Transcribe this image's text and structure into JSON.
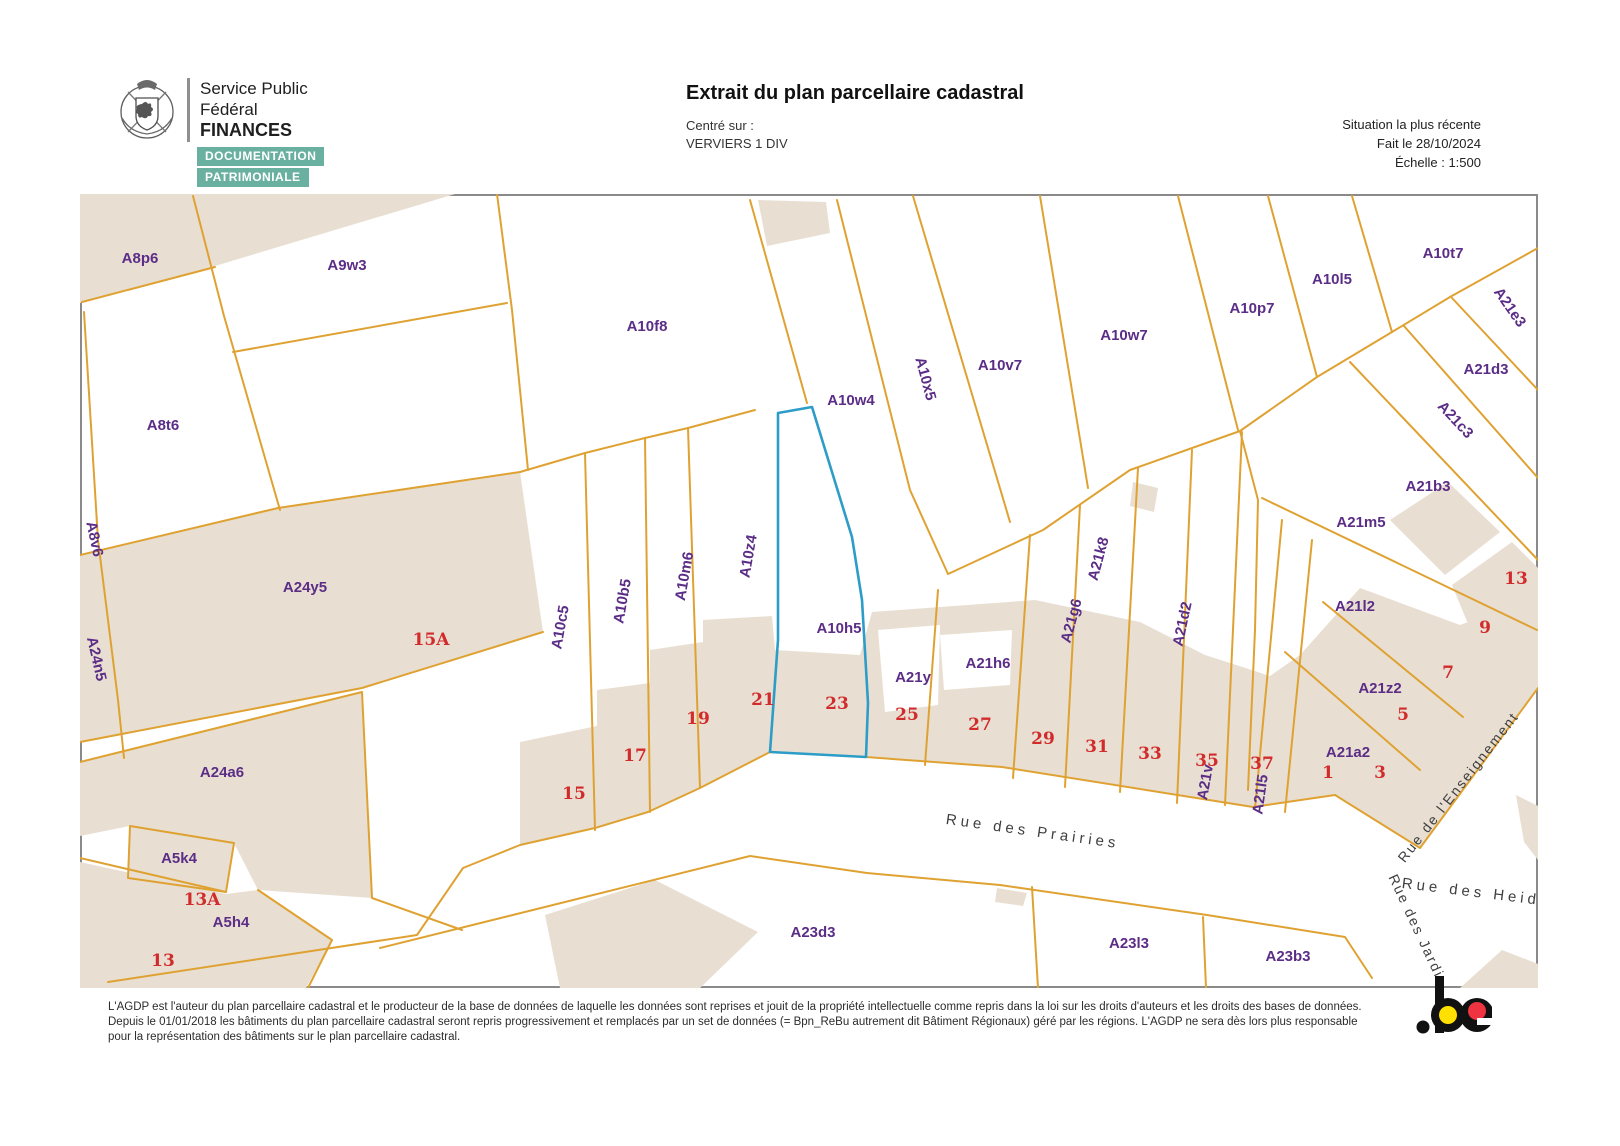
{
  "header": {
    "org_line1": "Service Public",
    "org_line2": "Fédéral",
    "org_line3": "FINANCES",
    "badge1": "DOCUMENTATION",
    "badge2": "PATRIMONIALE",
    "title": "Extrait du plan parcellaire cadastral",
    "centered_on_label": "Centré sur :",
    "centered_on_value": "VERVIERS 1 DIV",
    "situation": "Situation la plus récente",
    "date": "Fait le 28/10/2024",
    "scale": "Échelle : 1:500"
  },
  "colors": {
    "building_fill": "#e8dfd2",
    "parcel_line": "#dfa232",
    "highlight_line": "#2d9dc8",
    "parcel_label": "#5b2d86",
    "house_number": "#d22b2b",
    "street_label": "#3f3f3f",
    "badge_bg": "#6ab0a0",
    "logo_yellow": "#ffe000",
    "logo_red": "#ef3340"
  },
  "map": {
    "parcel_labels": [
      {
        "t": "A8p6",
        "x": 140,
        "y": 263,
        "r": 0
      },
      {
        "t": "A9w3",
        "x": 347,
        "y": 270,
        "r": 0
      },
      {
        "t": "A8t6",
        "x": 163,
        "y": 430,
        "r": 0
      },
      {
        "t": "A8v6",
        "x": 90,
        "y": 540,
        "r": 78
      },
      {
        "t": "A24n5",
        "x": 92,
        "y": 660,
        "r": 77
      },
      {
        "t": "A24y5",
        "x": 305,
        "y": 592,
        "r": 0
      },
      {
        "t": "A24a6",
        "x": 222,
        "y": 777,
        "r": 0
      },
      {
        "t": "A5k4",
        "x": 179,
        "y": 863,
        "r": 0
      },
      {
        "t": "A5h4",
        "x": 231,
        "y": 927,
        "r": 0
      },
      {
        "t": "A10f8",
        "x": 647,
        "y": 331,
        "r": 0
      },
      {
        "t": "A10w4",
        "x": 851,
        "y": 405,
        "r": 0
      },
      {
        "t": "A10x5",
        "x": 921,
        "y": 380,
        "r": 75
      },
      {
        "t": "A10v7",
        "x": 1000,
        "y": 370,
        "r": 0
      },
      {
        "t": "A10w7",
        "x": 1124,
        "y": 340,
        "r": 0
      },
      {
        "t": "A10p7",
        "x": 1252,
        "y": 313,
        "r": 0
      },
      {
        "t": "A10l5",
        "x": 1332,
        "y": 284,
        "r": 0
      },
      {
        "t": "A10t7",
        "x": 1443,
        "y": 258,
        "r": 0
      },
      {
        "t": "A21e3",
        "x": 1506,
        "y": 310,
        "r": 55
      },
      {
        "t": "A21d3",
        "x": 1486,
        "y": 374,
        "r": 0
      },
      {
        "t": "A21c3",
        "x": 1452,
        "y": 423,
        "r": 47
      },
      {
        "t": "A21b3",
        "x": 1428,
        "y": 491,
        "r": 0
      },
      {
        "t": "A21m5",
        "x": 1361,
        "y": 527,
        "r": 0
      },
      {
        "t": "A10c5",
        "x": 565,
        "y": 628,
        "r": -80
      },
      {
        "t": "A10b5",
        "x": 627,
        "y": 602,
        "r": -80
      },
      {
        "t": "A10m6",
        "x": 689,
        "y": 577,
        "r": -80
      },
      {
        "t": "A10z4",
        "x": 753,
        "y": 557,
        "r": -80
      },
      {
        "t": "A10h5",
        "x": 839,
        "y": 633,
        "r": 0
      },
      {
        "t": "A21y",
        "x": 913,
        "y": 682,
        "r": 0
      },
      {
        "t": "A21h6",
        "x": 988,
        "y": 668,
        "r": 0
      },
      {
        "t": "A21g6",
        "x": 1076,
        "y": 622,
        "r": -75
      },
      {
        "t": "A21k8",
        "x": 1103,
        "y": 560,
        "r": -75
      },
      {
        "t": "A21d2",
        "x": 1187,
        "y": 625,
        "r": -78
      },
      {
        "t": "A21v",
        "x": 1210,
        "y": 783,
        "r": -80
      },
      {
        "t": "A21l5",
        "x": 1265,
        "y": 795,
        "r": -82
      },
      {
        "t": "A21l2",
        "x": 1355,
        "y": 611,
        "r": 0
      },
      {
        "t": "A21z2",
        "x": 1380,
        "y": 693,
        "r": 0
      },
      {
        "t": "A21a2",
        "x": 1348,
        "y": 757,
        "r": 0
      },
      {
        "t": "A23d3",
        "x": 813,
        "y": 937,
        "r": 0
      },
      {
        "t": "A23l3",
        "x": 1129,
        "y": 948,
        "r": 0
      },
      {
        "t": "A23b3",
        "x": 1288,
        "y": 961,
        "r": 0
      }
    ],
    "house_numbers": [
      {
        "t": "15A",
        "x": 431,
        "y": 645
      },
      {
        "t": "15",
        "x": 574,
        "y": 799
      },
      {
        "t": "17",
        "x": 635,
        "y": 761
      },
      {
        "t": "19",
        "x": 698,
        "y": 724
      },
      {
        "t": "21",
        "x": 763,
        "y": 705
      },
      {
        "t": "23",
        "x": 837,
        "y": 709
      },
      {
        "t": "25",
        "x": 907,
        "y": 720
      },
      {
        "t": "27",
        "x": 980,
        "y": 730
      },
      {
        "t": "29",
        "x": 1043,
        "y": 744
      },
      {
        "t": "31",
        "x": 1097,
        "y": 752
      },
      {
        "t": "33",
        "x": 1150,
        "y": 759
      },
      {
        "t": "35",
        "x": 1207,
        "y": 766
      },
      {
        "t": "37",
        "x": 1262,
        "y": 769
      },
      {
        "t": "13A",
        "x": 202,
        "y": 905
      },
      {
        "t": "13",
        "x": 163,
        "y": 966
      },
      {
        "t": "1",
        "x": 1328,
        "y": 778
      },
      {
        "t": "3",
        "x": 1380,
        "y": 778
      },
      {
        "t": "5",
        "x": 1403,
        "y": 720
      },
      {
        "t": "7",
        "x": 1448,
        "y": 678
      },
      {
        "t": "9",
        "x": 1485,
        "y": 633
      },
      {
        "t": "13",
        "x": 1516,
        "y": 584
      }
    ],
    "street_labels": [
      {
        "t": "Rue des Prairies",
        "x": 1032,
        "y": 836,
        "r": 8,
        "cls": "st"
      },
      {
        "t": "Rue de l'Enseignement",
        "x": 1462,
        "y": 790,
        "r": -52,
        "cls": "st small"
      },
      {
        "t": "Rue des Heids",
        "x": 1476,
        "y": 897,
        "r": 7,
        "cls": "st"
      },
      {
        "t": "Rue des Jardi",
        "x": 1412,
        "y": 928,
        "r": 65,
        "cls": "st small"
      }
    ]
  },
  "footer": {
    "line1": "L'AGDP est l'auteur du plan parcellaire cadastral et le producteur de la base de données de laquelle les données sont reprises et jouit de la propriété intellectuelle comme repris dans la loi sur les droits d'auteurs et les droits des bases de données. Depuis le 01/01/2018",
    "line2": "les bâtiments du plan parcellaire cadastral seront repris progressivement et remplacés par un set de données (= Bpn_ReBu autrement dit Bâtiment Régionaux) géré par les régions. L'AGDP ne sera dès lors plus responsable pour la représentation des bâtiments sur le",
    "line3": "plan parcellaire cadastral.",
    "be_logo": ".be"
  }
}
